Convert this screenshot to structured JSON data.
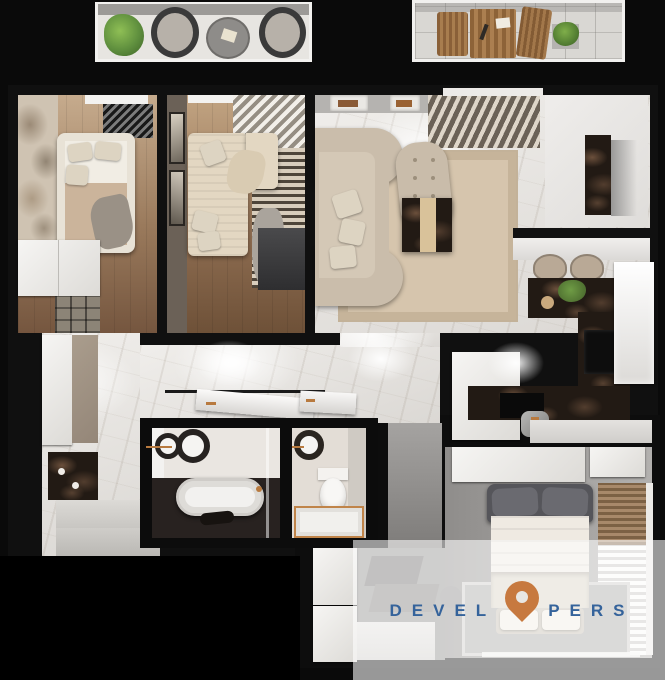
{
  "watermark": {
    "brand_full": "DEVELOPERS",
    "brand_left": "DEVEL",
    "brand_right": "PERS",
    "letter_o_replacement": "location-pin-icon",
    "text_color": "#35639b",
    "pin_color": "#c7793f",
    "overlay_color": "rgba(255,255,255,0.58)"
  },
  "colors": {
    "background": "#0a0a0a",
    "wall": "#101010",
    "marble_floor": "#e8e6e3",
    "dark_marble": "#221a14",
    "wood_floor": "#8a6a4f",
    "sofa_beige": "#cabdab",
    "concrete_gray": "#979593",
    "plant_green": "#5f8f3e",
    "copper_accent": "#b87a3f"
  }
}
